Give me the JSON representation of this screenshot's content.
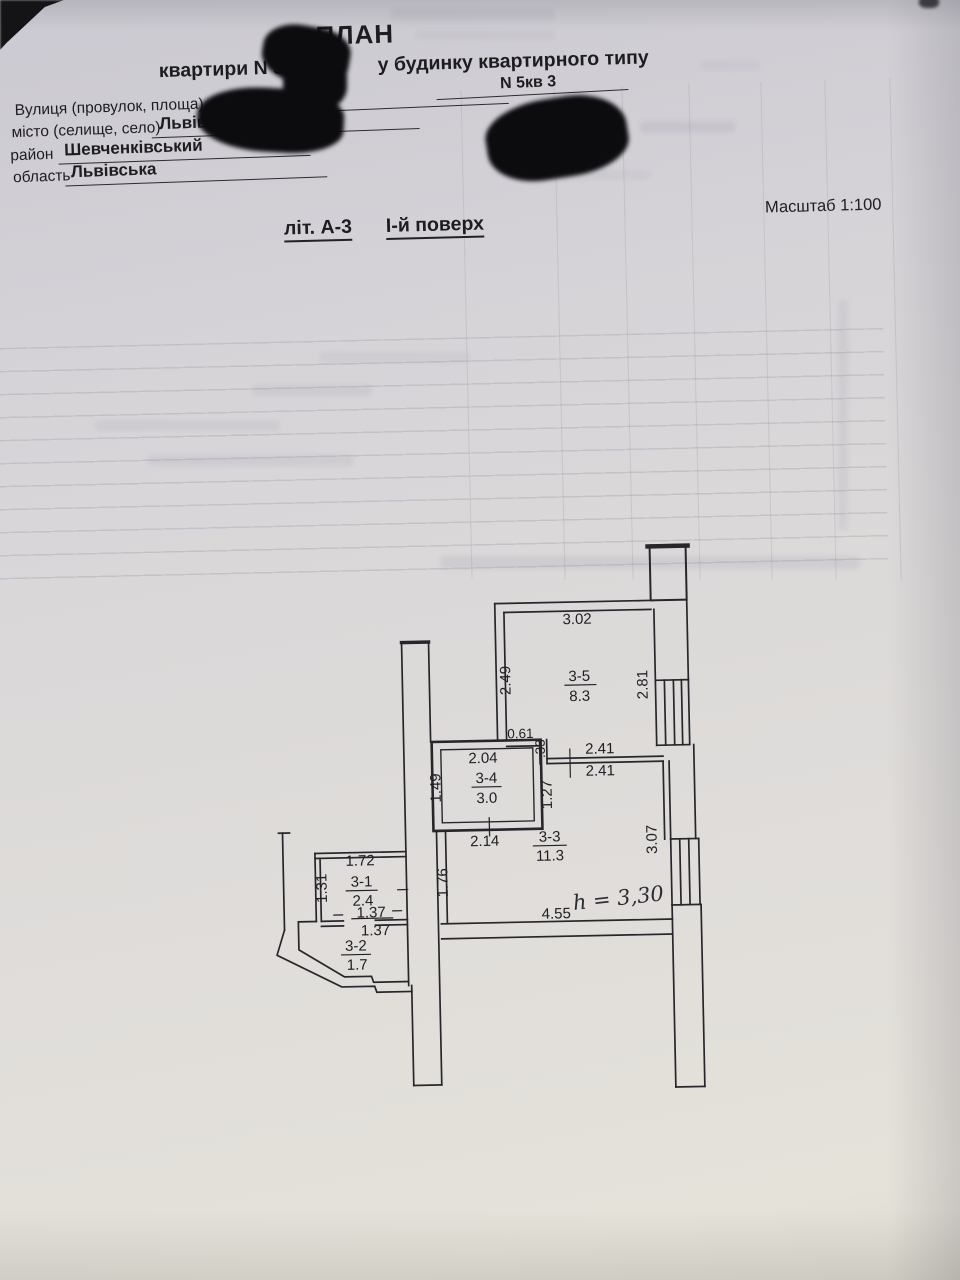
{
  "document": {
    "title": "ПЛАН",
    "subtitle_apartment": "квартири  N 3",
    "subtitle_building": "у будинку квартирного типу",
    "scale": "Масштаб 1:100",
    "letter": "літ. А-3",
    "floor": "І-й поверх",
    "address": {
      "street_label": "Вулиця (провулок, площа)",
      "house_number": "N  5кв 3",
      "city_label": "місто (селище, село)",
      "city": "Львів",
      "district_label": "район",
      "district": "Шевченківський",
      "region_label": "область",
      "region": "Львівська"
    }
  },
  "plan": {
    "height_note": "h = 3,30",
    "rooms": [
      {
        "id": "3-1",
        "area": "2.4"
      },
      {
        "id": "3-2",
        "area": "1.7"
      },
      {
        "id": "3-3",
        "area": "11.3"
      },
      {
        "id": "3-4",
        "area": "3.0"
      },
      {
        "id": "3-5",
        "area": "8.3"
      }
    ],
    "dims": {
      "room35_width": "3.02",
      "room35_left": "2.49",
      "room35_right": "2.81",
      "niche_width": "0.61",
      "niche_depth": ".33",
      "passage_top": "2.41",
      "passage_bottom": "2.41",
      "room34_width": "2.04",
      "room34_left": "1.49",
      "room34_right": "1.27",
      "room34_bottom": "2.14",
      "room33_right": "3.07",
      "room33_bottom": "4.55",
      "room33_left": "1.76",
      "room31_width": "1.72",
      "room31_left": "1.31",
      "door_width_top": "1.37",
      "door_width_bottom": "1.37"
    }
  }
}
